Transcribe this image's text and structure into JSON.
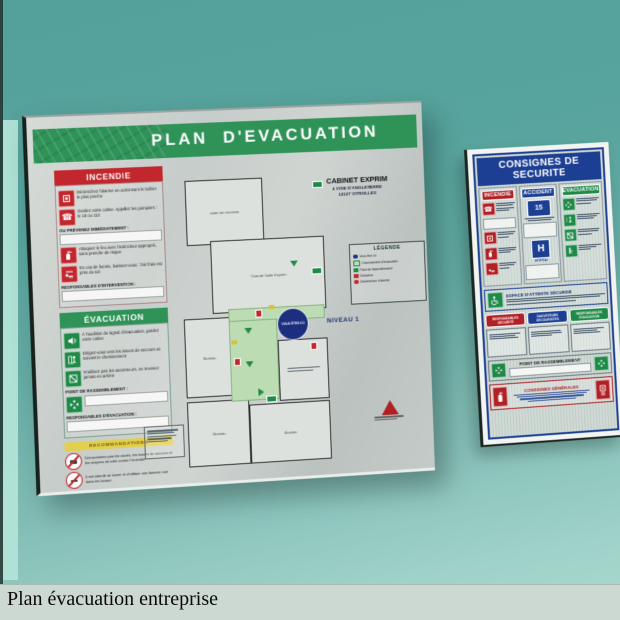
{
  "caption": "Plan évacuation entreprise",
  "colors": {
    "wall_teal": "#58a49e",
    "board_silver": "#c9cfcc",
    "green": "#2f9358",
    "red": "#c1272d",
    "blue": "#1c3f94",
    "corridor_green": "#bcdcb4",
    "you_are_here_blue": "#1b2f7e"
  },
  "evacuation_board": {
    "title": "PLAN  D'EVACUATION",
    "company": {
      "name": "CABINET EXPRIM",
      "address1": "4 VOIE D'ANGLETERRE",
      "address2": "13127 VITROLLES"
    },
    "level_label": "NIVEAU 1",
    "incendie": {
      "title": "INCENDIE",
      "instructions": [
        "Déclenchez l'alarme en actionnant le boîtier le plus proche",
        "Gardez votre calme. Appelez les pompiers : le 18 ou 112",
        "Attaquez le feu avec l'extincteur approprié, sans prendre de risque",
        "En cas de fumée, baissez-vous : l'air frais est près du sol"
      ],
      "notify_label": "OU PRÉVENEZ IMMÉDIATEMENT :",
      "responsables_label": "RESPONSABLES D'INTERVENTION :"
    },
    "evacuation": {
      "title": "ÉVACUATION",
      "instructions": [
        "À l'audition du signal d'évacuation, gardez votre calme",
        "Dirigez-vous vers les issues de secours en suivant le cheminement",
        "N'utilisez pas les ascenseurs, ne revenez jamais en arrière"
      ],
      "rally_label": "POINT DE RASSEMBLEMENT :",
      "responsables_label": "RESPONSABLES D'ÉVACUATION :"
    },
    "warnings": {
      "band_label": "RECOMMANDATIONS",
      "rows": [
        "N'encombrez pas les accès, les issues de secours et les moyens de lutte contre l'incendie",
        "Il est interdit de fumer et d'utiliser une flamme nue dans les locaux"
      ]
    },
    "legend": {
      "title": "LÉGENDE",
      "items": [
        "Vous êtes ici",
        "Cheminement d'évacuation",
        "Point de rassemblement",
        "Extincteur",
        "Déclencheur d'alarme"
      ]
    },
    "plan": {
      "you_are_here": "VOUS ÊTES ICI",
      "rooms": {
        "meeting": "Salle de Réunion",
        "main": "Grande Salle Exprim",
        "office1": "Bureau",
        "office2": "Bureau",
        "office3": "Bureau"
      }
    }
  },
  "safety_sign": {
    "title": "CONSIGNES DE SECURITE",
    "columns": {
      "fire": "INCENDIE",
      "accident": "ACCIDENT",
      "evacuation": "EVACUATION"
    },
    "samu_number": "15",
    "hospital_letter": "H",
    "hospital_label": "HÔPITAL",
    "secure_area_label": "ESPACE D'ATTENTE SÉCURISÉ",
    "pills": [
      "RESPONSABLES SÉCURITÉ",
      "SAUVETEURS SECOURISTES",
      "RESPONSABLES ÉVACUATION"
    ],
    "rally_label": "POINT DE RASSEMBLEMENT",
    "general_label": "CONSIGNES GÉNÉRALES"
  }
}
